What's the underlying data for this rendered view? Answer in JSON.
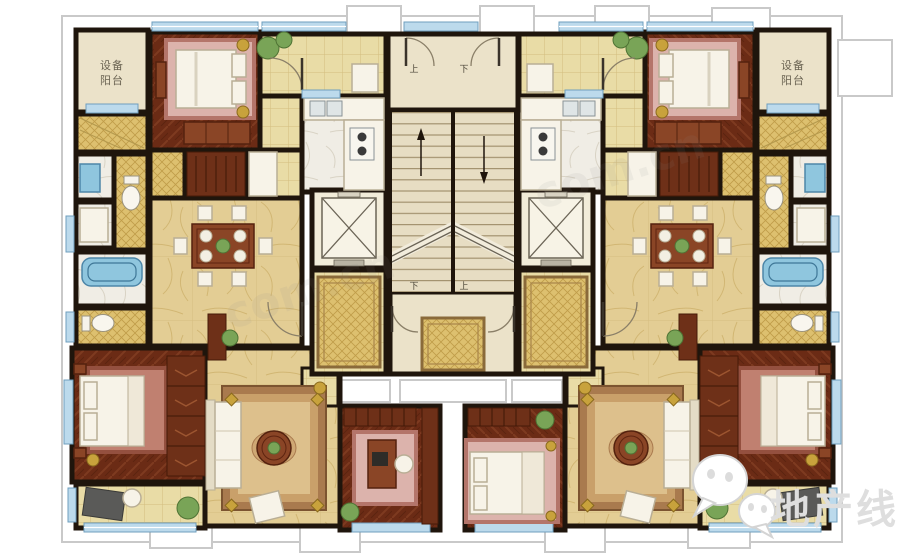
{
  "meta": {
    "title": "Residential floor plan - two mirrored units around a central core",
    "canvas": {
      "width": 900,
      "height": 554
    }
  },
  "labels": {
    "equipment_balcony": {
      "line1": "设备",
      "line2": "阳台"
    },
    "stairs": {
      "top_left": "上",
      "top_right": "下",
      "bottom_left": "下",
      "bottom_right": "上"
    }
  },
  "watermark": {
    "brand": "地产线",
    "icon": "wechat-icon",
    "site_fragment": "com.cn"
  },
  "colors": {
    "wall": "#1f150c",
    "window_blue": "#bcdaec",
    "fixture_blue": "#8fc6de",
    "wood_floor": "#6b2b15",
    "tile_gold": "#e9dca6",
    "mosaic_gold": "#ddc06f",
    "marble_gold": "#e3cd94",
    "cream": "#ebe2c9",
    "rug_pink": "#dcb3ac",
    "accent_gold": "#c8a23c",
    "plant_green": "#79a457"
  },
  "plan": {
    "core": {
      "features": [
        "entry landing",
        "double-flight staircase",
        "elevator left",
        "elevator right",
        "lift lobby left",
        "lift lobby right",
        "corridor"
      ]
    },
    "unit_left": {
      "rooms": [
        "equipment balcony (设备阳台)",
        "bedroom",
        "entry hall",
        "kitchen",
        "bathroom suite (shower, WC, bathtub)",
        "dining room (8-seat table)",
        "lift lobby",
        "living room",
        "master bedroom",
        "study",
        "balcony"
      ]
    },
    "unit_right": {
      "rooms": [
        "equipment balcony (设备阳台)",
        "bedroom",
        "entry hall",
        "kitchen",
        "bathroom suite (shower, WC, bathtub)",
        "dining room (8-seat table)",
        "lift lobby",
        "living room",
        "master bedroom",
        "bedroom 2",
        "balcony"
      ]
    }
  }
}
